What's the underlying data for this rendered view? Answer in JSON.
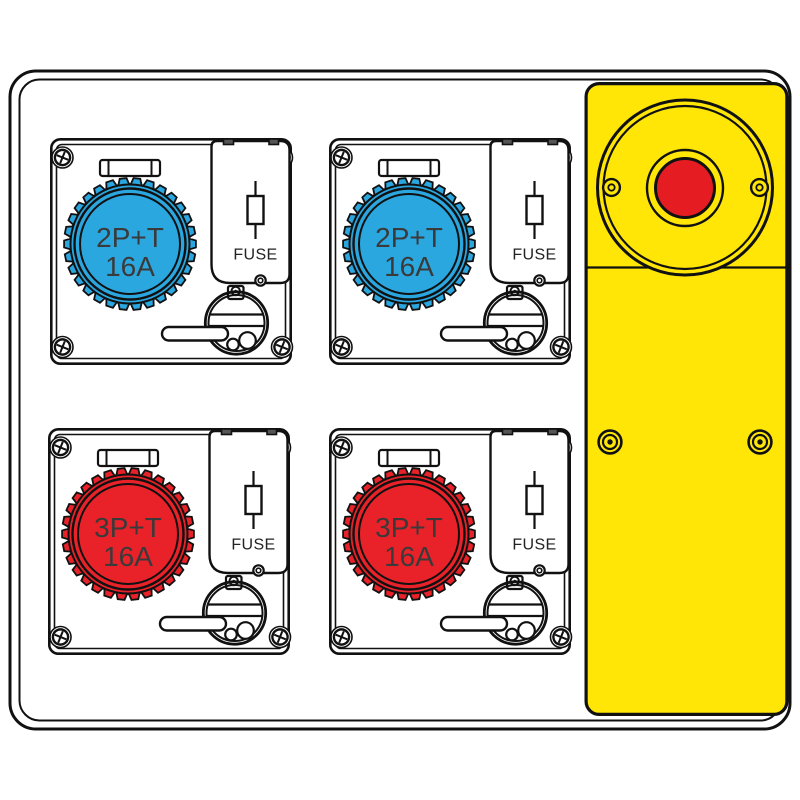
{
  "board": {
    "kind": "distribution-board-technical-drawing",
    "outline_color": "#111111",
    "background_color": "#ffffff"
  },
  "units": [
    {
      "id": "socket-unit-top-left",
      "label_line1": "2P+T",
      "label_line2": "16A",
      "fuse_label": "FUSE",
      "socket_color": "#2ba7e0"
    },
    {
      "id": "socket-unit-top-right",
      "label_line1": "2P+T",
      "label_line2": "16A",
      "fuse_label": "FUSE",
      "socket_color": "#2ba7e0"
    },
    {
      "id": "socket-unit-bottom-left",
      "label_line1": "3P+T",
      "label_line2": "16A",
      "fuse_label": "FUSE",
      "socket_color": "#e9222a"
    },
    {
      "id": "socket-unit-bottom-right",
      "label_line1": "3P+T",
      "label_line2": "16A",
      "fuse_label": "FUSE",
      "socket_color": "#e9222a"
    }
  ],
  "emergency": {
    "panel_color": "#ffe606",
    "button_color": "#e51d23"
  }
}
